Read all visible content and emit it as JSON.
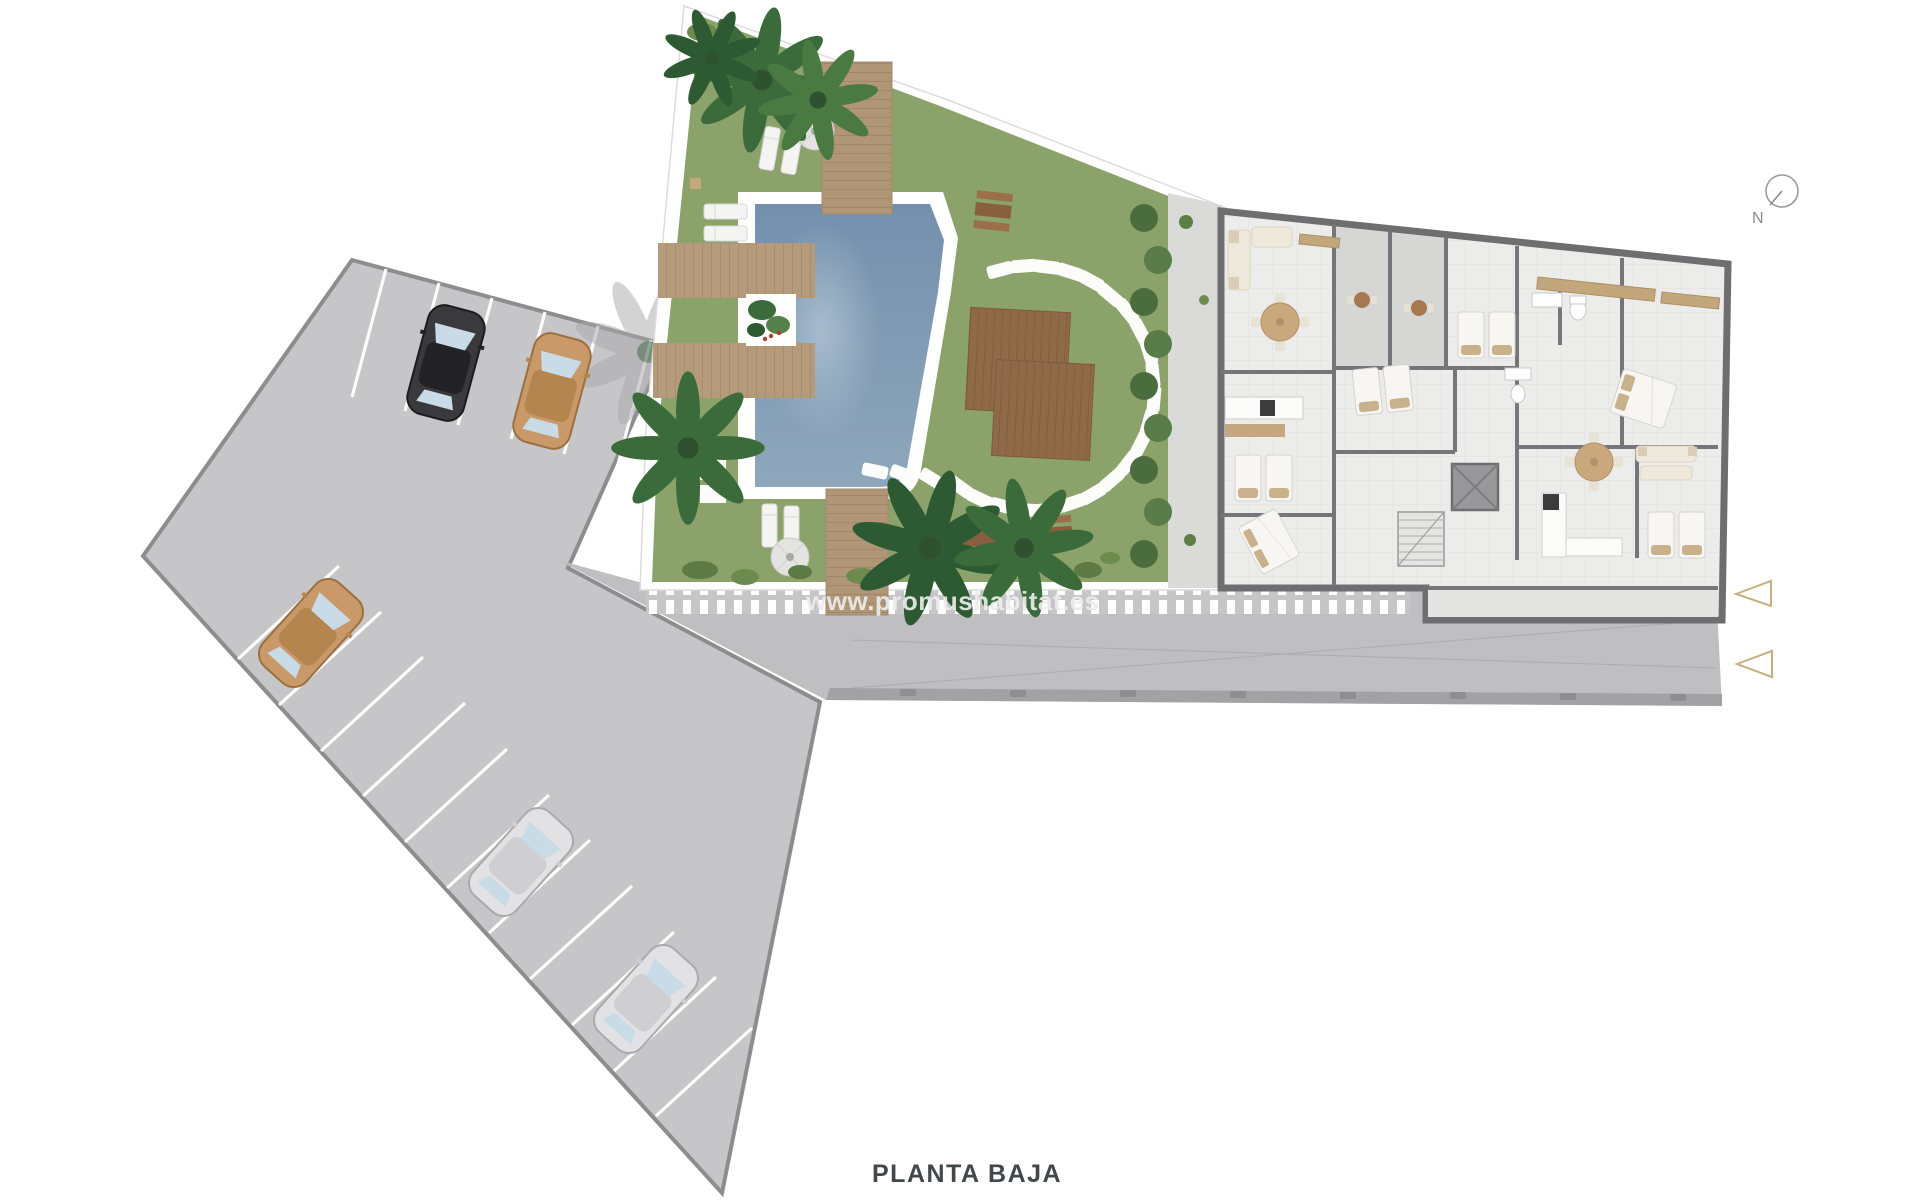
{
  "canvas": {
    "width": 1920,
    "height": 1200,
    "background": "#ffffff"
  },
  "title": {
    "label": "PLANTA BAJA",
    "color": "#42474b"
  },
  "compass": {
    "label": "N"
  },
  "watermark": {
    "text": "www.promushabitat.es"
  },
  "palette": {
    "parking": "#c6c6c8",
    "road": "#bfbfc1",
    "curb": "#a2a2a4",
    "lawn": "#8ba26a",
    "hedge": "#4a6c3e",
    "pool_water_top": "#7490ad",
    "pool_water_bottom": "#8ea7bc",
    "deck_wood": "#b3997a",
    "platform_wood": "#8f6a48",
    "building_floor": "#ececeb",
    "building_wall": "#6e6e71",
    "terrace_tile": "#d6d6d4",
    "furniture_wood": "#c8a87c",
    "bed_linen": "#f7f6f2",
    "pillow": "#c9b18b",
    "car_black": "#3a3a3c",
    "car_tan": "#c9996a",
    "car_silver": "#e2e2e4",
    "arrow_accent": "#c7ae7f"
  },
  "plan": {
    "floor": "PLANTA BAJA",
    "parking": {
      "rows": 2,
      "stall_dividers": 17,
      "cars": [
        {
          "color_name": "black"
        },
        {
          "color_name": "tan"
        },
        {
          "color_name": "tan"
        },
        {
          "color_name": "silver"
        },
        {
          "color_name": "silver"
        }
      ]
    },
    "garden": {
      "pool": 1,
      "stepping_stones": 25,
      "sun_loungers": 6,
      "parasols": 2,
      "wood_decks": 2,
      "boardwalks": 2,
      "picnic_tables": 3,
      "wood_platforms": 2,
      "palm_trees": 6
    },
    "building": {
      "twin_bed_rooms": 4,
      "double_beds": 2,
      "dining_tables": 2,
      "sofas": 2,
      "kitchens": 2,
      "bathrooms": 2,
      "terraces": 2,
      "elevators": 1,
      "stairs": 1
    },
    "direction_arrows": 2
  }
}
